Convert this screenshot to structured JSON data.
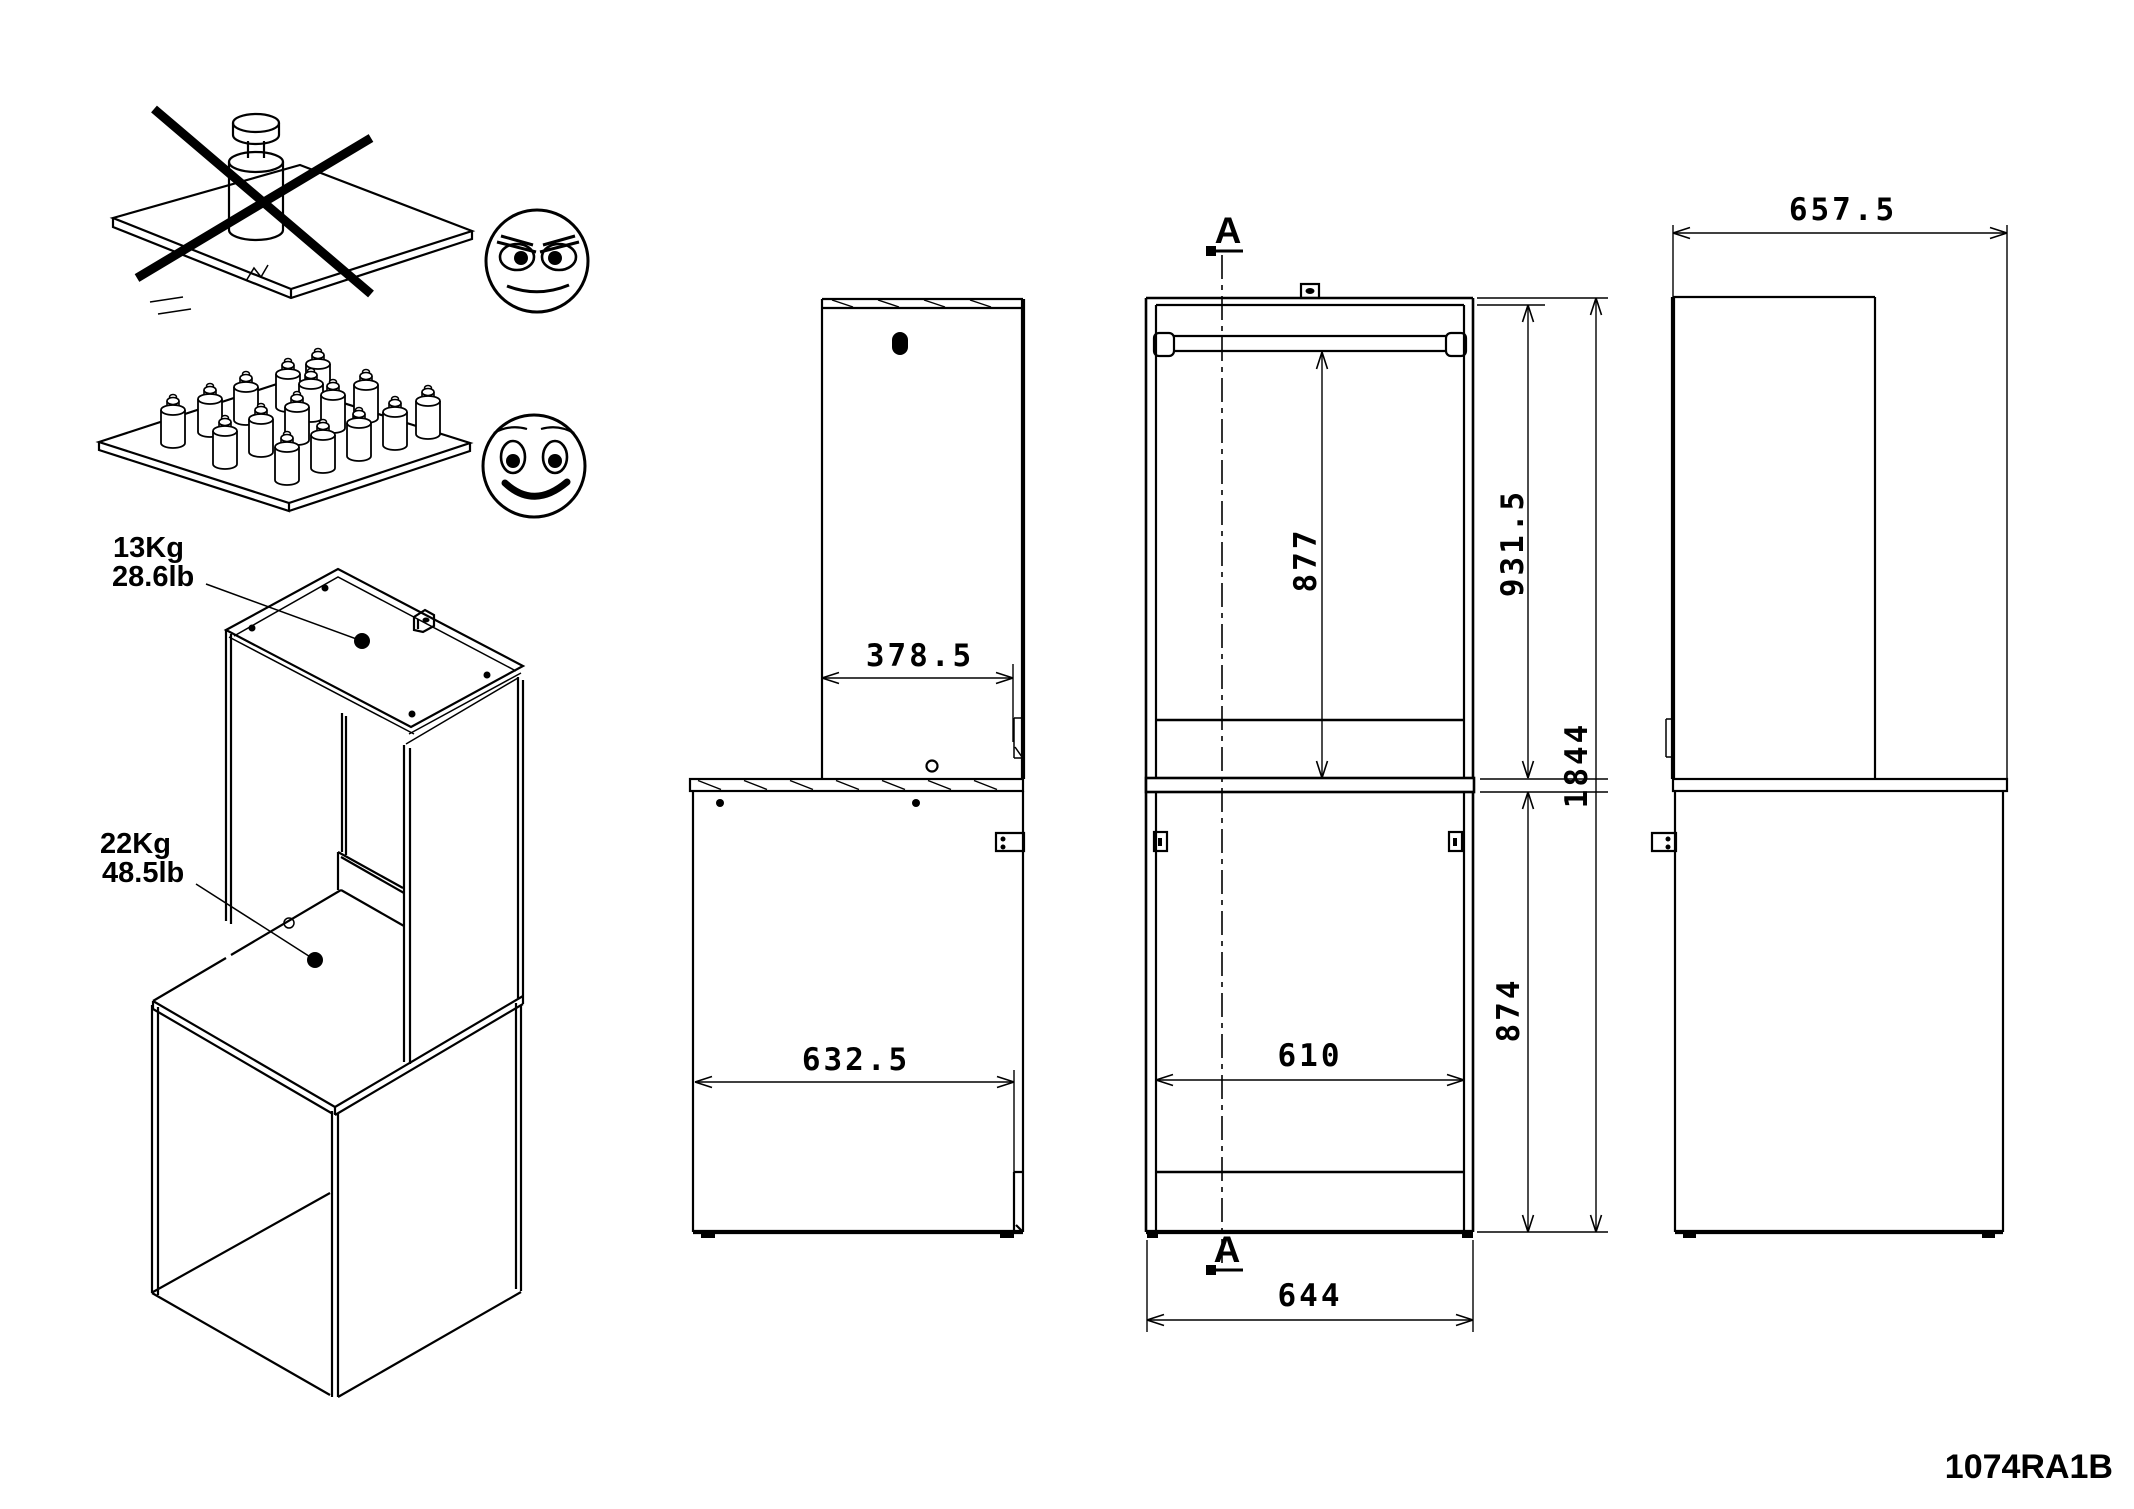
{
  "part_number": "1074RA1B",
  "load_labels": {
    "top_kg": "13Kg",
    "top_lb": "28.6lb",
    "desk_kg": "22Kg",
    "desk_lb": "48.5lb"
  },
  "dimensions": {
    "tower_depth": "378.5",
    "cabinet_depth": "632.5",
    "upper_inner_height": "877",
    "upper_height": "931.5",
    "lower_height": "874",
    "total_height": "1844",
    "inner_width": "610",
    "total_width": "644",
    "total_depth": "657.5"
  },
  "section": {
    "label": "A"
  }
}
